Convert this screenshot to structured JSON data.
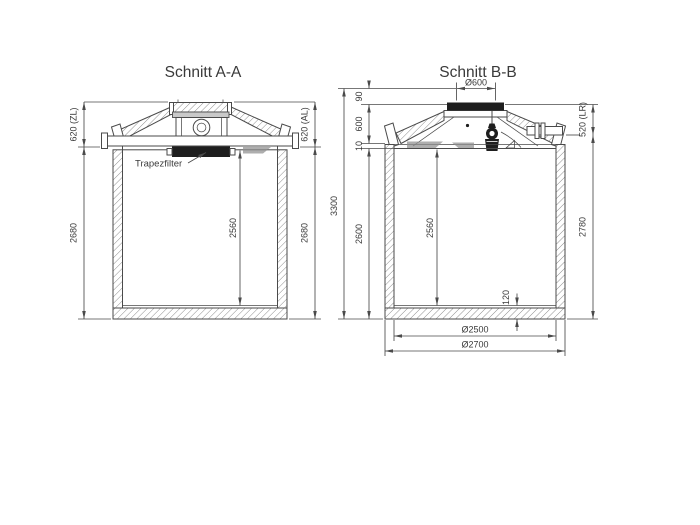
{
  "drawing": {
    "section_a": {
      "title": "Schnitt A-A",
      "label_trapezfilter": "Trapezfilter",
      "dim_inlet_depth_left": "620 (ZL)",
      "dim_outlet_depth_right": "620 (AL)",
      "dim_body_height_left": "2680",
      "dim_body_height_right": "2680",
      "dim_inner_height": "2560"
    },
    "section_b": {
      "title": "Schnitt B-B",
      "dim_opening_diameter": "Ø600",
      "dim_cover_offset": "90",
      "dim_dome_height": "600",
      "dim_joint": "10",
      "dim_total_height": "3300",
      "dim_body_height": "2600",
      "dim_inner_height": "2560",
      "dim_conduit_depth": "520 (LR)",
      "dim_outer_body_height": "2780",
      "dim_floor_thickness": "120",
      "dim_inner_diameter": "Ø2500",
      "dim_outer_diameter": "Ø2700"
    }
  },
  "colors": {
    "line": "#4a4a4a",
    "text": "#3a3a3a",
    "dark": "#1e1e1e",
    "bg": "#ffffff",
    "shade": "#8f8f8f",
    "plate": "#c9c9c9"
  }
}
